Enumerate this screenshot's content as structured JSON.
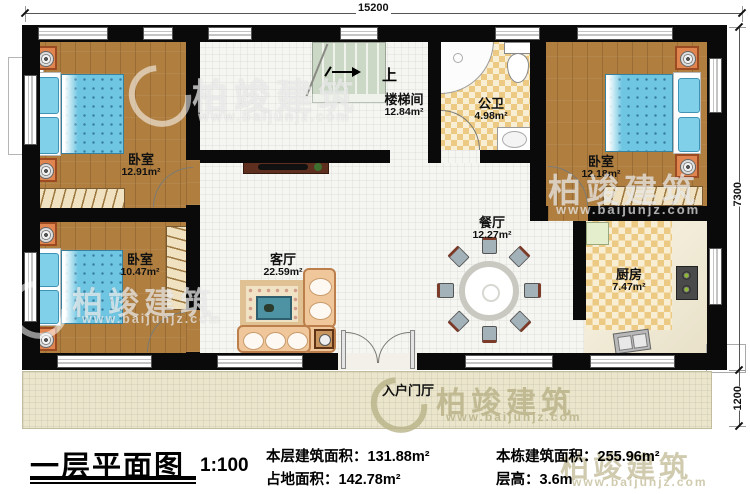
{
  "dimensions": {
    "top": "15200",
    "right": "7300",
    "porch": "1200"
  },
  "rooms": {
    "bedroom1": {
      "name": "卧室",
      "area": "12.91m²"
    },
    "bedroom2": {
      "name": "卧室",
      "area": "10.47m²"
    },
    "bedroom3": {
      "name": "卧室",
      "area": "12.18m²"
    },
    "stairwell": {
      "name": "楼梯间",
      "area": "12.84m²"
    },
    "bathroom": {
      "name": "公卫",
      "area": "4.98m²"
    },
    "living": {
      "name": "客厅",
      "area": "22.59m²"
    },
    "dining": {
      "name": "餐厅",
      "area": "12.27m²"
    },
    "kitchen": {
      "name": "厨房",
      "area": "7.47m²"
    },
    "foyer": {
      "name": "入户门厅"
    }
  },
  "stair_up": "上",
  "watermark": {
    "brand": "柏竣建筑",
    "url": "www.baijunjz.com"
  },
  "title_block": {
    "title": "一层平面图",
    "scale": "1:100",
    "stats": [
      {
        "label": "本层建筑面积：",
        "value": "131.88m²"
      },
      {
        "label": "占地面积：",
        "value": "142.78m²"
      },
      {
        "label": "本栋建筑面积：",
        "value": "255.96m²"
      },
      {
        "label": "层高：",
        "value": "3.6m"
      }
    ]
  },
  "colors": {
    "wall": "#0a0a0a",
    "wood_floor": "#b07f40",
    "bed": "#6fc6e2",
    "nightstand": "#e0854f",
    "checker_tile": "#ecca83",
    "porch": "#eae5cb",
    "sofa": "#efc79b"
  }
}
